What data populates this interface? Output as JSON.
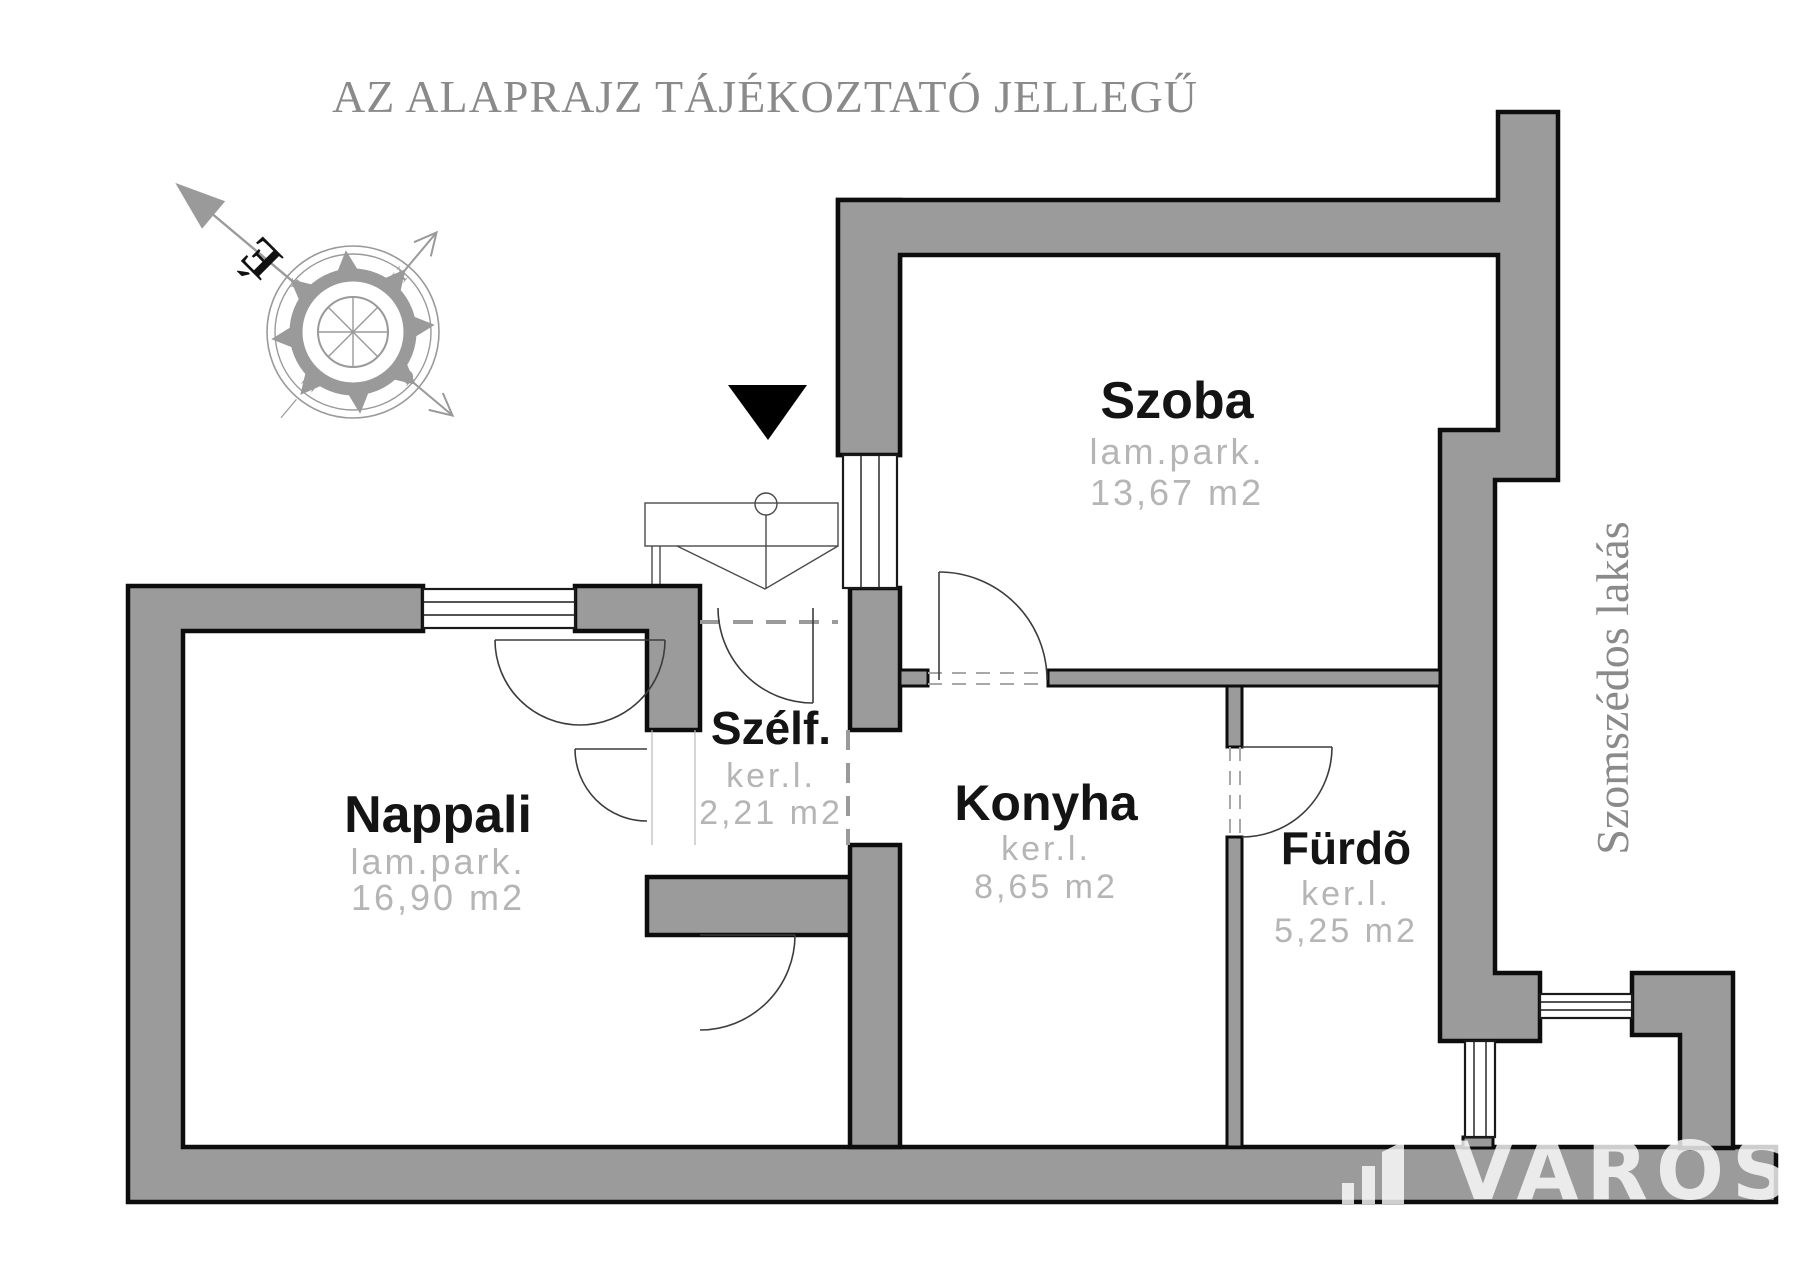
{
  "title": "AZ ALAPRAJZ TÁJÉKOZTATÓ JELLEGŰ",
  "rooms": {
    "szoba": {
      "name": "Szoba",
      "floor": "lam.park.",
      "area": "13,67  m2"
    },
    "nappali": {
      "name": "Nappali",
      "floor": "lam.park.",
      "area": "16,90  m2"
    },
    "szelfogo": {
      "name": "Szélf.",
      "floor": "ker.l.",
      "area": "2,21  m2"
    },
    "konyha": {
      "name": "Konyha",
      "floor": "ker.l.",
      "area": "8,65  m2"
    },
    "furdo": {
      "name": "Fürdõ",
      "floor": "ker.l.",
      "area": "5,25  m2"
    }
  },
  "neighbor_label": "Szomszédos lakás",
  "compass": {
    "north_big": "É",
    "ring_north": "É",
    "ring_east": "NY",
    "ring_south": "D",
    "ring_west": "K"
  },
  "watermark": "VAROSI",
  "colors": {
    "wall_fill": "#9b9b9b",
    "outline": "#0d0d0d",
    "room_name": "#141414",
    "room_sub": "#b5b5b5",
    "annotation_gray": "#8a8a8a",
    "entrance_marker": "#000000"
  }
}
